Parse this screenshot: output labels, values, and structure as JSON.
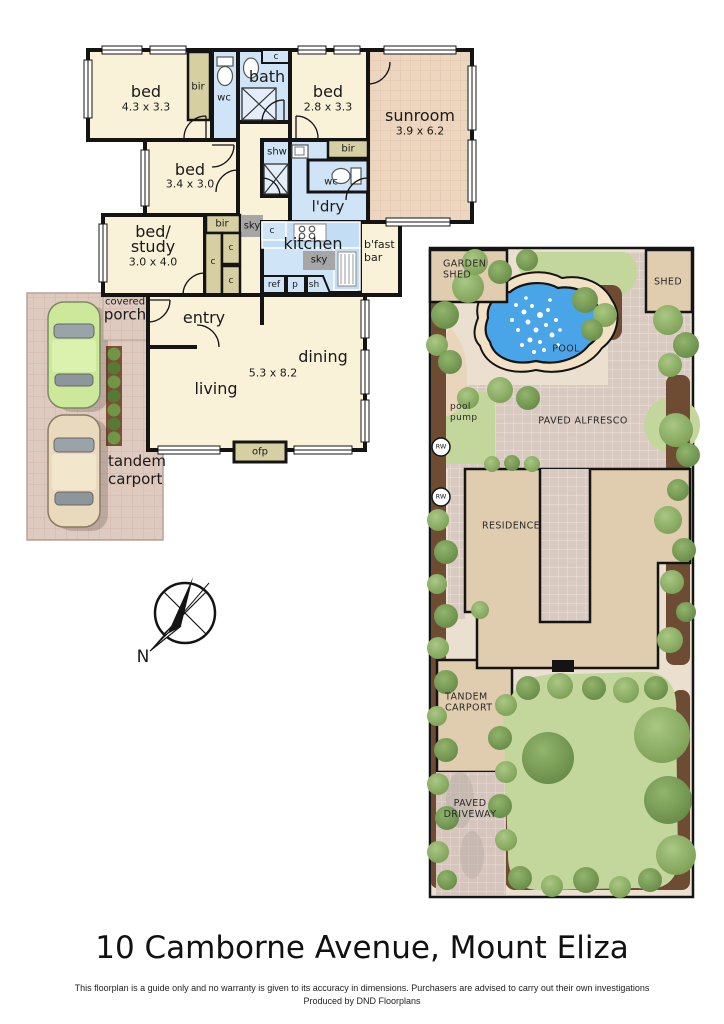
{
  "fp": {
    "bed1": {
      "name": "bed",
      "dims": "4.3 x 3.3"
    },
    "bed2": {
      "name": "bed",
      "dims": "2.8 x 3.3"
    },
    "bed3": {
      "name": "bed",
      "dims": "3.4 x 3.0"
    },
    "bed_study": {
      "line1": "bed/",
      "line2": "study",
      "dims": "3.0 x 4.0"
    },
    "sunroom": {
      "name": "sunroom",
      "dims": "3.9 x 6.2"
    },
    "bath": "bath",
    "wc": "wc",
    "shw": "shw",
    "ldry": "l'dry",
    "kitchen": "kitchen",
    "bfast_bar": "b'fast bar",
    "bir": "bir",
    "sky": "sky",
    "c": "c",
    "ref": "ref",
    "p": "p",
    "sh": "sh",
    "ofp": "ofp",
    "entry": "entry",
    "living": "living",
    "dining": "dining",
    "living_dims": "5.3 x 8.2",
    "covered_line1": "covered",
    "covered_line2": "porch",
    "tandem_carport": "tandem carport"
  },
  "site": {
    "garden_shed": "GARDEN SHED",
    "shed": "SHED",
    "pool": "POOL",
    "pool_pump": "pool pump",
    "paved_alfresco": "PAVED ALFRESCO",
    "residence": "RESIDENCE",
    "tandem_carport": "TANDEM CARPORT",
    "paved_driveway": "PAVED DRIVEWAY",
    "rw": "RW"
  },
  "compass": {
    "north": "N"
  },
  "footer": {
    "title": "10 Camborne Avenue, Mount Eliza",
    "disclaimer": "This floorplan is a guide only and no warranty is given to  its accuracy in dimensions.  Purchasers are advised to carry out their own investigations",
    "produced_by": "Produced by DND Floorplans"
  },
  "colors": {
    "wall": "#141414",
    "room_cream": "#faf2d8",
    "wet_blue": "#cfe4f6",
    "robe_olive": "#d6cfa2",
    "skylight_gray": "#a6a6a6",
    "sunroom_tile": "#ecd6bf",
    "porch_tile": "#dfcabf",
    "pool_blue": "#49a5e7",
    "lawn_green": "#c3d79c",
    "tree_green": "#7b9e53",
    "residence_tan": "#e0ccae",
    "paving_mauve": "#d8cac0",
    "garden_bed_brown": "#6e4c34"
  }
}
